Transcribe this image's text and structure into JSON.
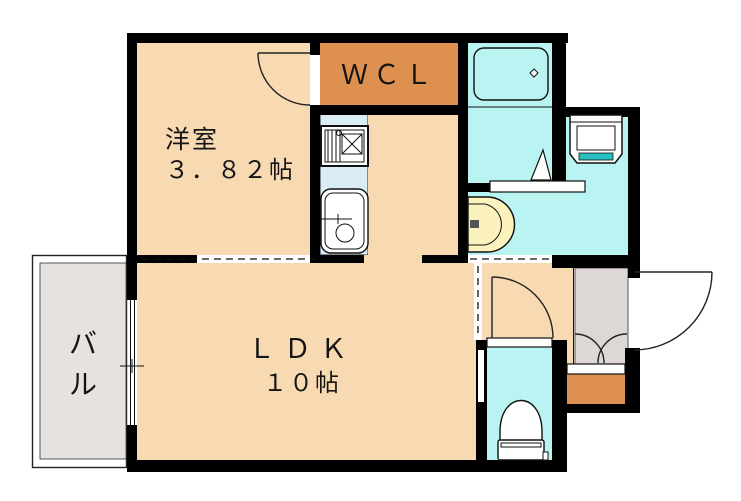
{
  "plan": {
    "rooms": {
      "yoshitsu": {
        "name": "洋室",
        "size": "３．８２帖"
      },
      "wcl": {
        "label": "ＷＣＬ"
      },
      "ldk": {
        "name": "ＬＤＫ",
        "size": "１０帖"
      },
      "balcony": {
        "name_line1": "バ",
        "name_line2": "ル"
      }
    },
    "fixtures": [
      "bathtub-icon",
      "washing-machine-icon",
      "washbasin-icon",
      "toilet-icon",
      "stove-icon",
      "kitchen-sink-icon"
    ],
    "colors": {
      "room_peach": "#F8DAB2",
      "closet_orange": "#DE9050",
      "water_cyan": "#B9F3F2",
      "kitchen_blue": "#DAEDF6",
      "balcony_gray": "#E6E2E0",
      "entrance_gray": "#DDD8D6",
      "basin_yellow": "#FBF2BE",
      "washer_teal": "#29BFC0",
      "wall_black": "#000000"
    }
  }
}
